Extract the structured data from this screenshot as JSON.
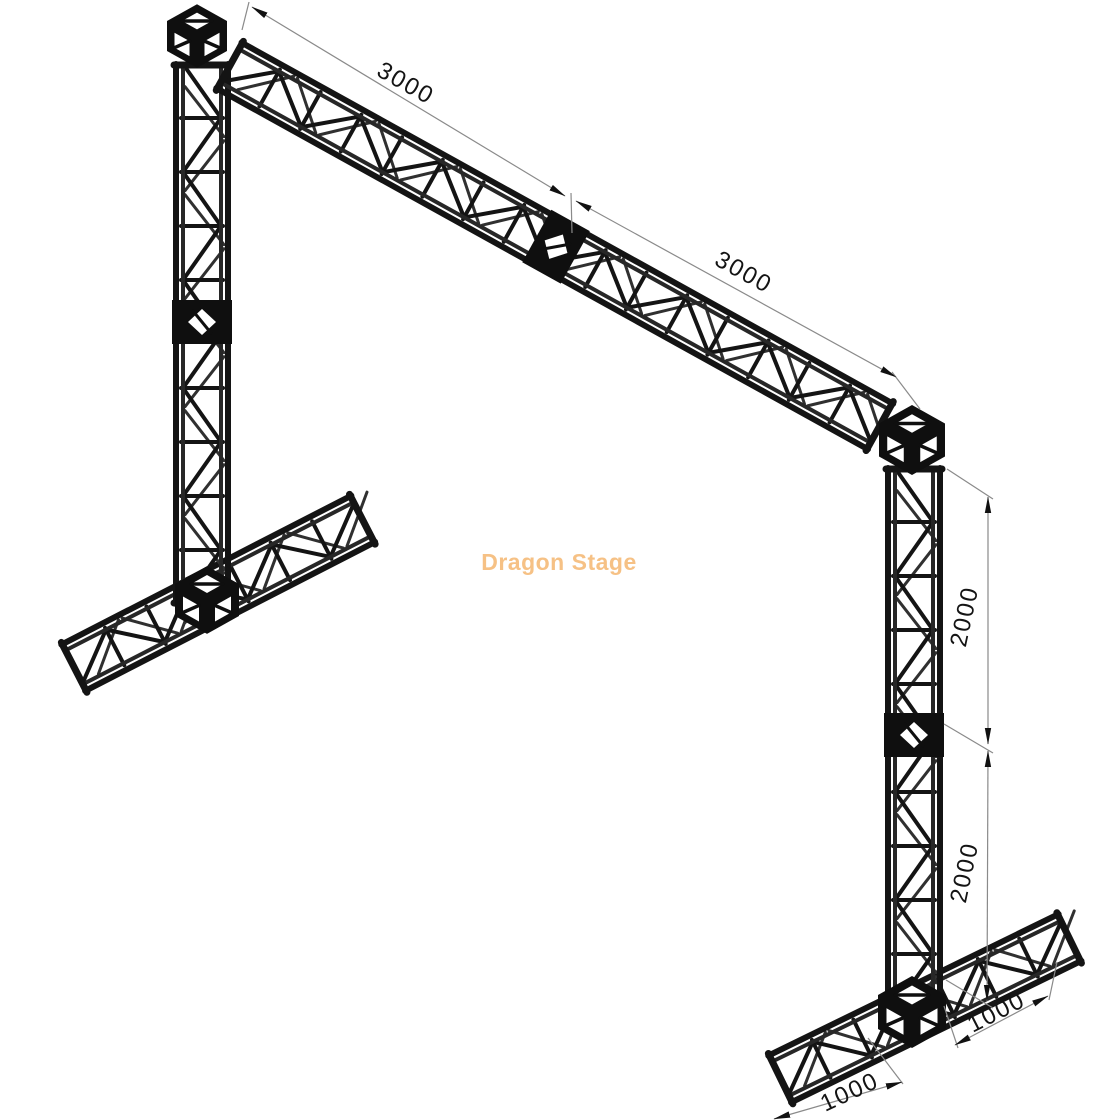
{
  "drawing": {
    "type": "isometric-truss-technical-drawing",
    "watermark": {
      "text": "Dragon Stage",
      "color": "#F6C185"
    },
    "dimensions": {
      "beam_left": "3000",
      "beam_right": "3000",
      "column_upper": "2000",
      "column_lower": "2000",
      "base_left": "1000",
      "base_right": "1000"
    },
    "colors": {
      "structure": "#141414",
      "structure_far_face": "#303030",
      "dimension_line": "#8a8a8a",
      "dimension_text": "#141414",
      "background": "#ffffff"
    }
  }
}
